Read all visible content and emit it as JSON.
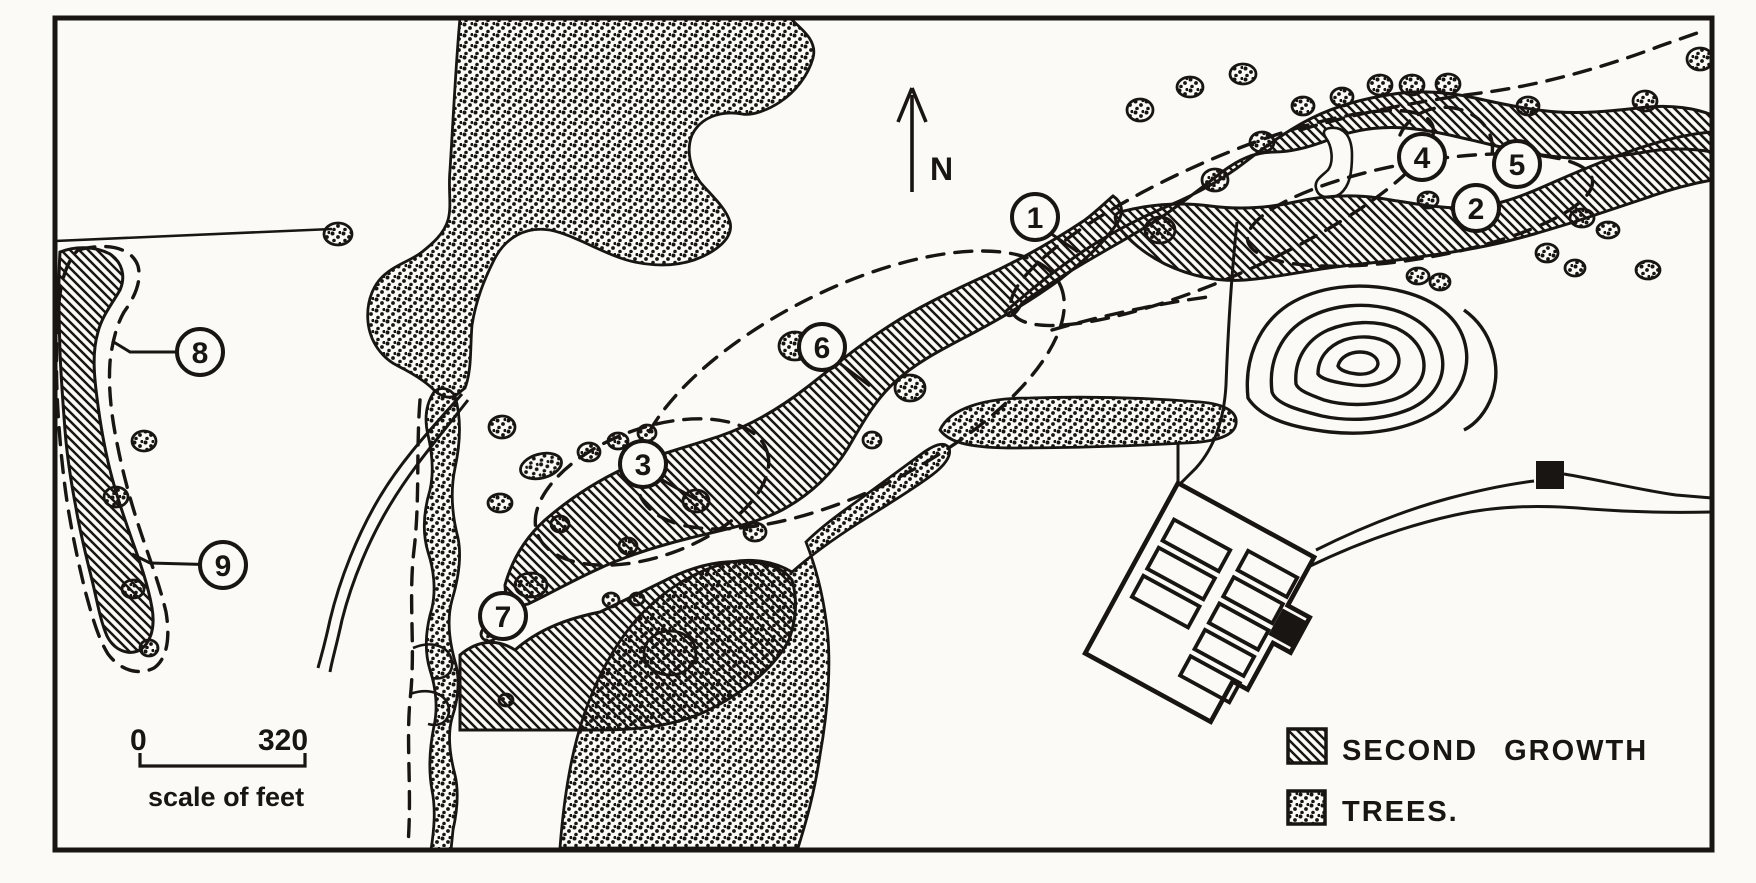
{
  "map": {
    "north_label": "N",
    "markers": [
      {
        "label": "1",
        "x": 1035,
        "y": 217,
        "leader": [
          [
            1050,
            233
          ],
          [
            1078,
            252
          ]
        ]
      },
      {
        "label": "2",
        "x": 1476,
        "y": 208,
        "leader": []
      },
      {
        "label": "3",
        "x": 643,
        "y": 464,
        "leader": [
          [
            659,
            478
          ],
          [
            697,
            500
          ]
        ]
      },
      {
        "label": "4",
        "x": 1422,
        "y": 157,
        "leader": []
      },
      {
        "label": "5",
        "x": 1517,
        "y": 164,
        "leader": []
      },
      {
        "label": "6",
        "x": 822,
        "y": 347,
        "leader": [
          [
            838,
            362
          ],
          [
            870,
            386
          ]
        ]
      },
      {
        "label": "7",
        "x": 503,
        "y": 616,
        "leader": []
      },
      {
        "label": "8",
        "x": 200,
        "y": 352,
        "leader": [
          [
            130,
            352
          ],
          [
            112,
            341
          ]
        ]
      },
      {
        "label": "9",
        "x": 223,
        "y": 565,
        "leader": [
          [
            150,
            563
          ],
          [
            132,
            554
          ]
        ]
      }
    ],
    "legend": {
      "items": [
        {
          "label": "SECOND GROWTH",
          "swatch": "second-growth-hatch"
        },
        {
          "label": "TREES.",
          "swatch": "trees-stipple"
        }
      ]
    },
    "scale_bar": {
      "start_label": "0",
      "end_label": "320",
      "caption": "scale of feet"
    },
    "colors": {
      "ink": "#181512",
      "paper": "#fbfaf7"
    }
  }
}
